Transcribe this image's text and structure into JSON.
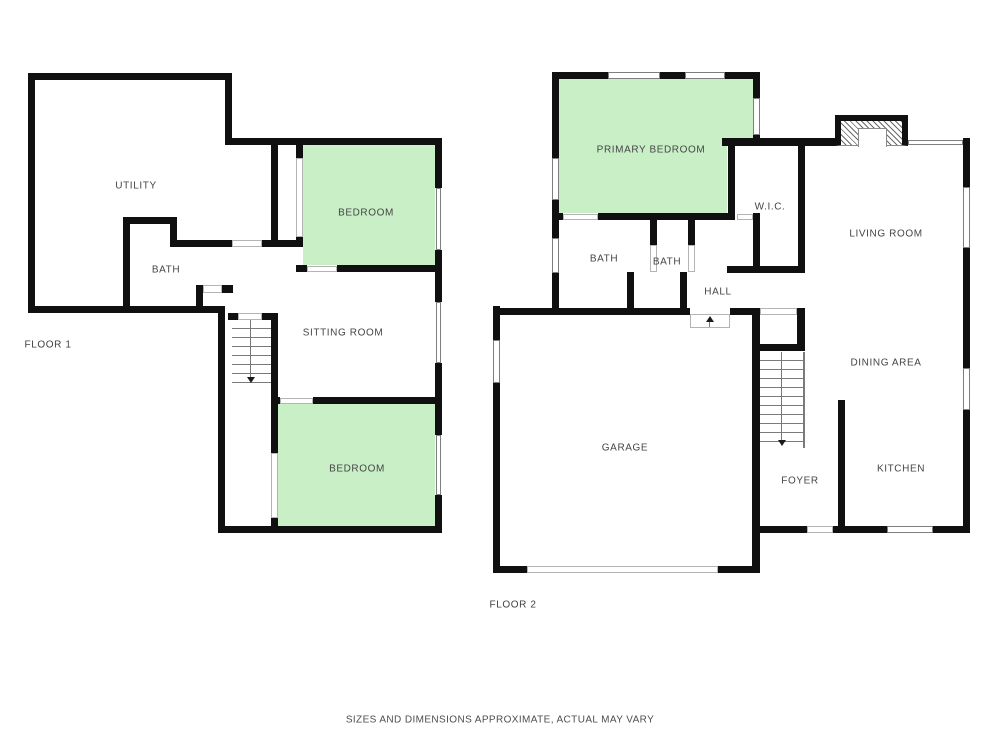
{
  "meta": {
    "disclaimer": "SIZES AND DIMENSIONS APPROXIMATE, ACTUAL MAY VARY"
  },
  "colors": {
    "wall": "#101010",
    "room_highlight_fill": "#c9efc7",
    "label_text": "#454545"
  },
  "floor1": {
    "title": "FLOOR 1",
    "rooms": {
      "utility": "UTILITY",
      "bath": "BATH",
      "bedroom_top": "BEDROOM",
      "sitting_room": "SITTING ROOM",
      "bedroom_bottom": "BEDROOM"
    }
  },
  "floor2": {
    "title": "FLOOR 2",
    "rooms": {
      "primary_bedroom": "PRIMARY BEDROOM",
      "wic": "W.I.C.",
      "living_room": "LIVING ROOM",
      "bath_left": "BATH",
      "bath_right": "BATH",
      "hall": "HALL",
      "dining_area": "DINING AREA",
      "garage": "GARAGE",
      "foyer": "FOYER",
      "kitchen": "KITCHEN"
    }
  }
}
